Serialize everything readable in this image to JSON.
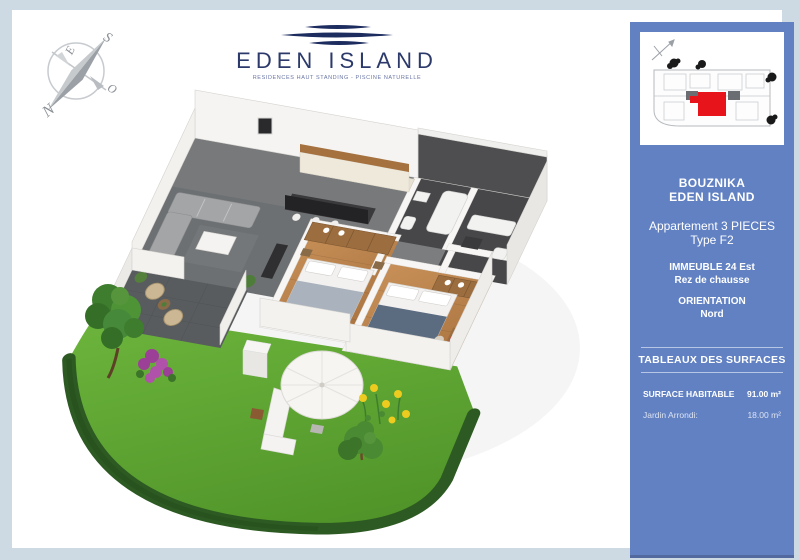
{
  "document": {
    "type": "apartment-brochure-sheet",
    "colors": {
      "outer_border": "#cdd9e3",
      "sidebar_blue": "#6181c3",
      "unit_highlight_red": "#e8141c",
      "brand_navy": "#2c3a6b",
      "grass_green": "#5aa32e",
      "wood_floor": "#bd8850"
    }
  },
  "logo": {
    "brand": "EDEN ISLAND",
    "tagline": "RESIDENCES HAUT STANDING - PISCINE NATURELLE"
  },
  "compass": {
    "n": "N",
    "s": "S",
    "e": "E",
    "o": "O"
  },
  "sidebar": {
    "project_city": "BOUZNIKA",
    "project_name": "EDEN ISLAND",
    "apartment_line1": "Appartement 3 PIECES",
    "apartment_line2": "Type F2",
    "building": "IMMEUBLE 24 Est",
    "floor": "Rez de chausse",
    "orientation_label": "ORIENTATION",
    "orientation_value": "Nord",
    "surfaces_title": "TABLEAUX DES SURFACES",
    "surfaces": [
      {
        "label": "SURFACE HABITABLE",
        "value": "91.00 m²"
      },
      {
        "label": "Jardin Arrondi:",
        "value": "18.00 m²"
      }
    ]
  }
}
